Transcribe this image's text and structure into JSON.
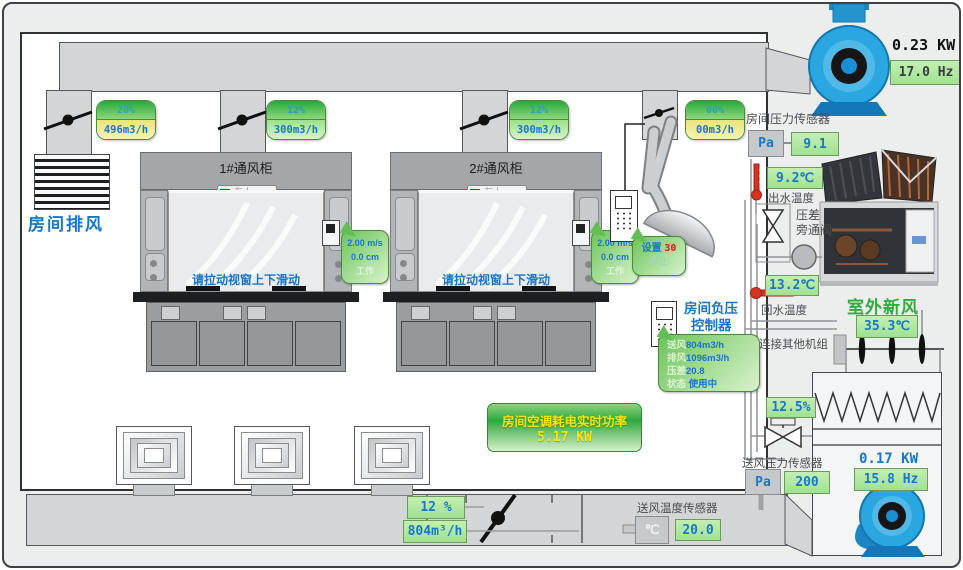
{
  "room": {
    "exhaust_grille_label": "房间排风"
  },
  "branch_labels": [
    {
      "pct": "20%",
      "flow": "496m3/h",
      "flow_class": "cell flow yellow"
    },
    {
      "pct": "12%",
      "flow": "300m3/h",
      "flow_class": "cell flow green"
    },
    {
      "pct": "12%",
      "flow": "300m3/h",
      "flow_class": "cell flow green"
    },
    {
      "pct": "00%",
      "flow": "00m3/h",
      "flow_class": "cell flow yellow"
    }
  ],
  "hoods": [
    {
      "title": "1#通风柜",
      "badge": "有人",
      "hint": "请拉动视窗上下滑动",
      "face_velocity": "2.00 m/s",
      "sash_height": "0.0 cm",
      "status": "工作"
    },
    {
      "title": "2#通风柜",
      "badge": "有人",
      "hint": "请拉动视窗上下滑动",
      "face_velocity": "2.00 m/s",
      "sash_height": "0.0 cm",
      "status": "工作"
    }
  ],
  "snorkel": {
    "set_label": "设置",
    "set_value": "30",
    "stop_label": "停止"
  },
  "exhaust_fan": {
    "kw": "0.23 KW",
    "hz": "17.0 Hz"
  },
  "supply_fan": {
    "kw": "0.17 KW",
    "hz": "15.8 Hz"
  },
  "room_pressure": {
    "label": "房间压力传感器",
    "unit": "Pa",
    "value": "9.1"
  },
  "supply_pressure": {
    "label": "送风压力传感器",
    "unit": "Pa",
    "value": "200"
  },
  "supply_temp": {
    "label": "送风温度传感器",
    "unit": "℃",
    "value": "20.0"
  },
  "chiller": {
    "supply_temp": "9.2℃",
    "supply_temp_label": "出水温度",
    "bypass_label_1": "压差",
    "bypass_label_2": "旁通阀",
    "return_temp": "13.2℃",
    "return_temp_label": "回水温度",
    "link_label": "连接其他机组"
  },
  "outdoor_air": {
    "title": "室外新风",
    "temp": "35.3℃"
  },
  "npc": {
    "title_1": "房间负压",
    "title_2": "控制器",
    "rows": [
      {
        "k": "送风",
        "v": "804m3/h"
      },
      {
        "k": "排风",
        "v": "1096m3/h"
      },
      {
        "k": "压差",
        "v": "20.8"
      },
      {
        "k": "状态",
        "v": "使用中"
      }
    ]
  },
  "power": {
    "line1": "房间空调耗电实时功率",
    "line2": "5.17 KW"
  },
  "supply_duct": {
    "pct": "12 %",
    "flow": "804m³/h"
  },
  "chw_valve": {
    "pct": "12.5%"
  }
}
